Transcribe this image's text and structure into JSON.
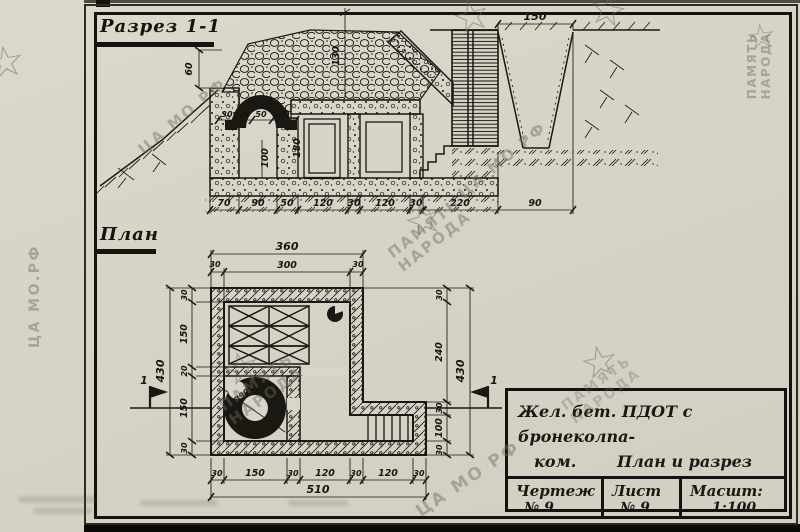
{
  "section": {
    "title": "Разрез 1-1",
    "dim_top": "150",
    "dims_bottom": [
      "70",
      "90",
      "50",
      "120",
      "30",
      "120",
      "30",
      "220",
      "90"
    ],
    "dim_niche": "60",
    "dim_crest": "130",
    "dims_cupola_base": [
      "30",
      "20",
      "50",
      "30"
    ],
    "dim_room_height": "100",
    "dim_door_height": "180"
  },
  "plan": {
    "title": "План",
    "dim_overall_top": "360",
    "dims_top": [
      "30",
      "300",
      "30"
    ],
    "dim_overall_left": "430",
    "dims_left": [
      "30",
      "150",
      "20",
      "150",
      "30"
    ],
    "dims_right": [
      "30",
      "240",
      "30",
      "100",
      "30"
    ],
    "dim_overall_right": "430",
    "dims_bottom": [
      "30",
      "150",
      "30",
      "120",
      "30",
      "120",
      "30"
    ],
    "dim_overall_bottom": "510",
    "cupola_label": "Ø90",
    "cut_marker": "1"
  },
  "title_block": {
    "line1": "Жел. бет. ПДОТ с бронеколпа-",
    "line2_left": "ком.",
    "line2_right": "План и разрез",
    "col1_label": "Чертеж",
    "col1_value": "№ 9",
    "col2_label": "Лист",
    "col2_value": "№ 9",
    "col3_label": "Масшт:",
    "col3_value": "1:100"
  },
  "watermarks": {
    "memory1": "ПАМЯТЬ",
    "memory2": "НАРОДА",
    "archive": "ЦА МО РФ",
    "archive_dotted": "ЦА МО.РФ",
    "star": "☆"
  }
}
